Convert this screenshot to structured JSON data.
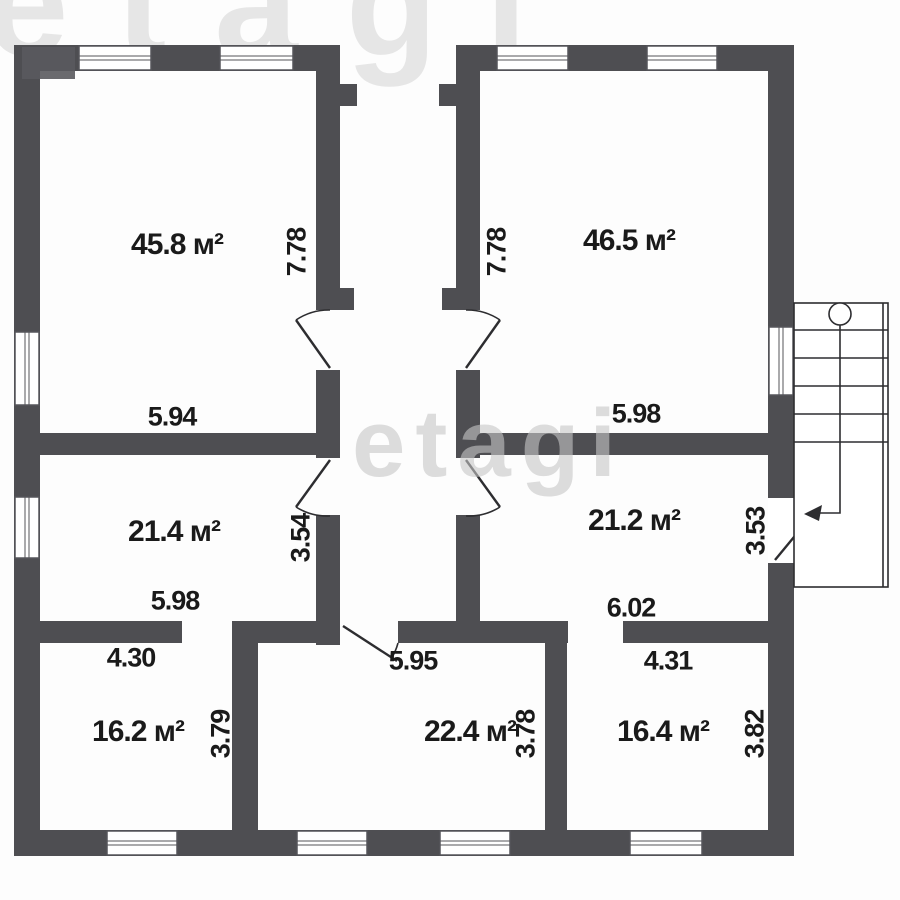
{
  "plan_title": "floor-plan",
  "watermarks": {
    "top": "etagi",
    "center": "etagi"
  },
  "colors": {
    "wall": "#4e4e52",
    "text": "#1a1a1a",
    "watermark": "#c7c7c7"
  },
  "rooms": [
    {
      "name": "top-left-room",
      "area": "45.8 м²",
      "width": "5.94",
      "height": "7.78"
    },
    {
      "name": "top-right-room",
      "area": "46.5 м²",
      "width": "5.98",
      "height": "7.78"
    },
    {
      "name": "middle-left-room",
      "area": "21.4 м²",
      "width": "5.98",
      "height": "3.54"
    },
    {
      "name": "middle-right-room",
      "area": "21.2 м²",
      "width": "6.02",
      "height": "3.53"
    },
    {
      "name": "bottom-left-room",
      "area": "16.2 м²",
      "width": "4.30",
      "height": "3.79"
    },
    {
      "name": "bottom-middle-room",
      "area": "22.4 м²",
      "width": "5.95",
      "height": "3.78"
    },
    {
      "name": "bottom-right-room",
      "area": "16.4 м²",
      "width": "4.31",
      "height": "3.82"
    }
  ]
}
